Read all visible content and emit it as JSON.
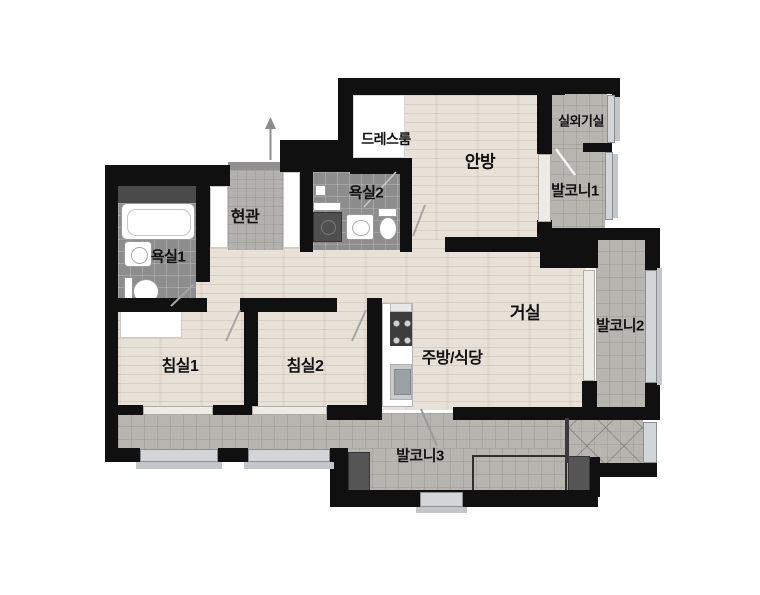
{
  "floor_plan": {
    "labels": [
      {
        "id": "dress-room",
        "text": "드레스룸",
        "x": 386,
        "y": 139,
        "size": 14
      },
      {
        "id": "master-bedroom",
        "text": "안방",
        "x": 480,
        "y": 160,
        "size": 17
      },
      {
        "id": "outdoor-unit-room",
        "text": "실외기실",
        "x": 581,
        "y": 120,
        "size": 13
      },
      {
        "id": "balcony-1",
        "text": "발코니1",
        "x": 575,
        "y": 190,
        "size": 15
      },
      {
        "id": "entrance",
        "text": "현관",
        "x": 245,
        "y": 215,
        "size": 16
      },
      {
        "id": "bathroom-2",
        "text": "욕실2",
        "x": 366,
        "y": 192,
        "size": 15
      },
      {
        "id": "bathroom-1",
        "text": "욕실1",
        "x": 168,
        "y": 256,
        "size": 15
      },
      {
        "id": "living-room",
        "text": "거실",
        "x": 525,
        "y": 311,
        "size": 17
      },
      {
        "id": "balcony-2",
        "text": "발코니2",
        "x": 620,
        "y": 325,
        "size": 15
      },
      {
        "id": "bedroom-1",
        "text": "침실1",
        "x": 180,
        "y": 364,
        "size": 16
      },
      {
        "id": "bedroom-2",
        "text": "침실2",
        "x": 305,
        "y": 364,
        "size": 16
      },
      {
        "id": "kitchen-dining",
        "text": "주방/식당",
        "x": 452,
        "y": 356,
        "size": 16
      },
      {
        "id": "balcony-3",
        "text": "발코니3",
        "x": 420,
        "y": 455,
        "size": 15
      }
    ],
    "colors": {
      "background": "#ffffff",
      "wall": "#101010",
      "wood": "#e8e1d8",
      "tile": "#b6b5b0",
      "bath_tile": "#8d8d8d",
      "entry_tile": "#b3b1ae",
      "window": "#d3d6d9",
      "window_light": "#edebe6",
      "sill": "#c3c6c8",
      "pad": "#555555",
      "label": "#111111"
    }
  }
}
